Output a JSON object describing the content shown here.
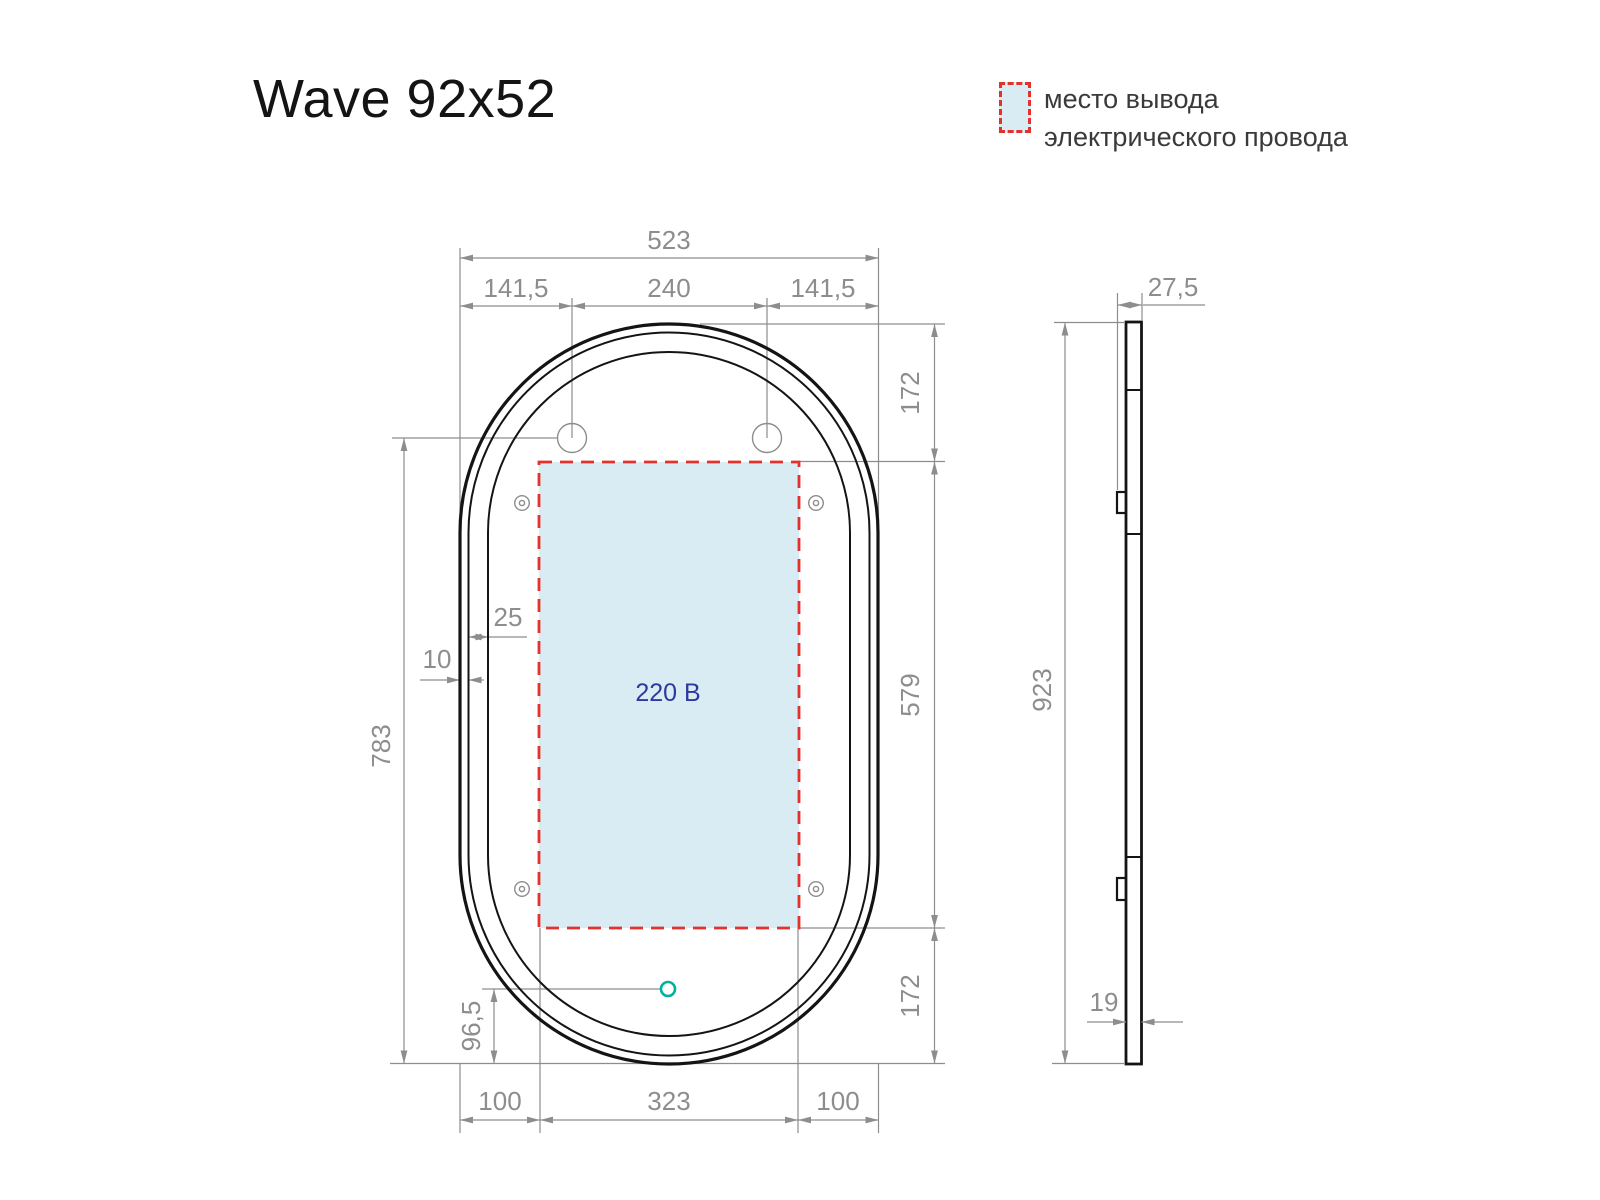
{
  "title": "Wave 92x52",
  "legend": {
    "line1": "место вывода",
    "line2": "электрического провода"
  },
  "colors": {
    "ink": "#141414",
    "line": "#8d8d8d",
    "red": "#e5312b",
    "zone_fill": "#d9ecf4",
    "voltage": "#2b3a9c",
    "teal": "#00b1a0",
    "text": "#3a3a3a"
  },
  "front_view": {
    "voltage_label": "220 В",
    "dims": {
      "overall_width": "523",
      "side_offset_left": "141,5",
      "hole_spacing": "240",
      "side_offset_right": "141,5",
      "top_to_zone": "172",
      "zone_height": "579",
      "zone_to_bottom": "172",
      "holes_to_bottom": "783",
      "sensor_to_bottom": "96,5",
      "frame_edge": "10",
      "led_band": "25",
      "zone_left_inset": "100",
      "zone_width": "323",
      "zone_right_inset": "100"
    }
  },
  "side_view": {
    "dims": {
      "depth": "27,5",
      "height": "923",
      "glass_thickness": "19"
    }
  }
}
